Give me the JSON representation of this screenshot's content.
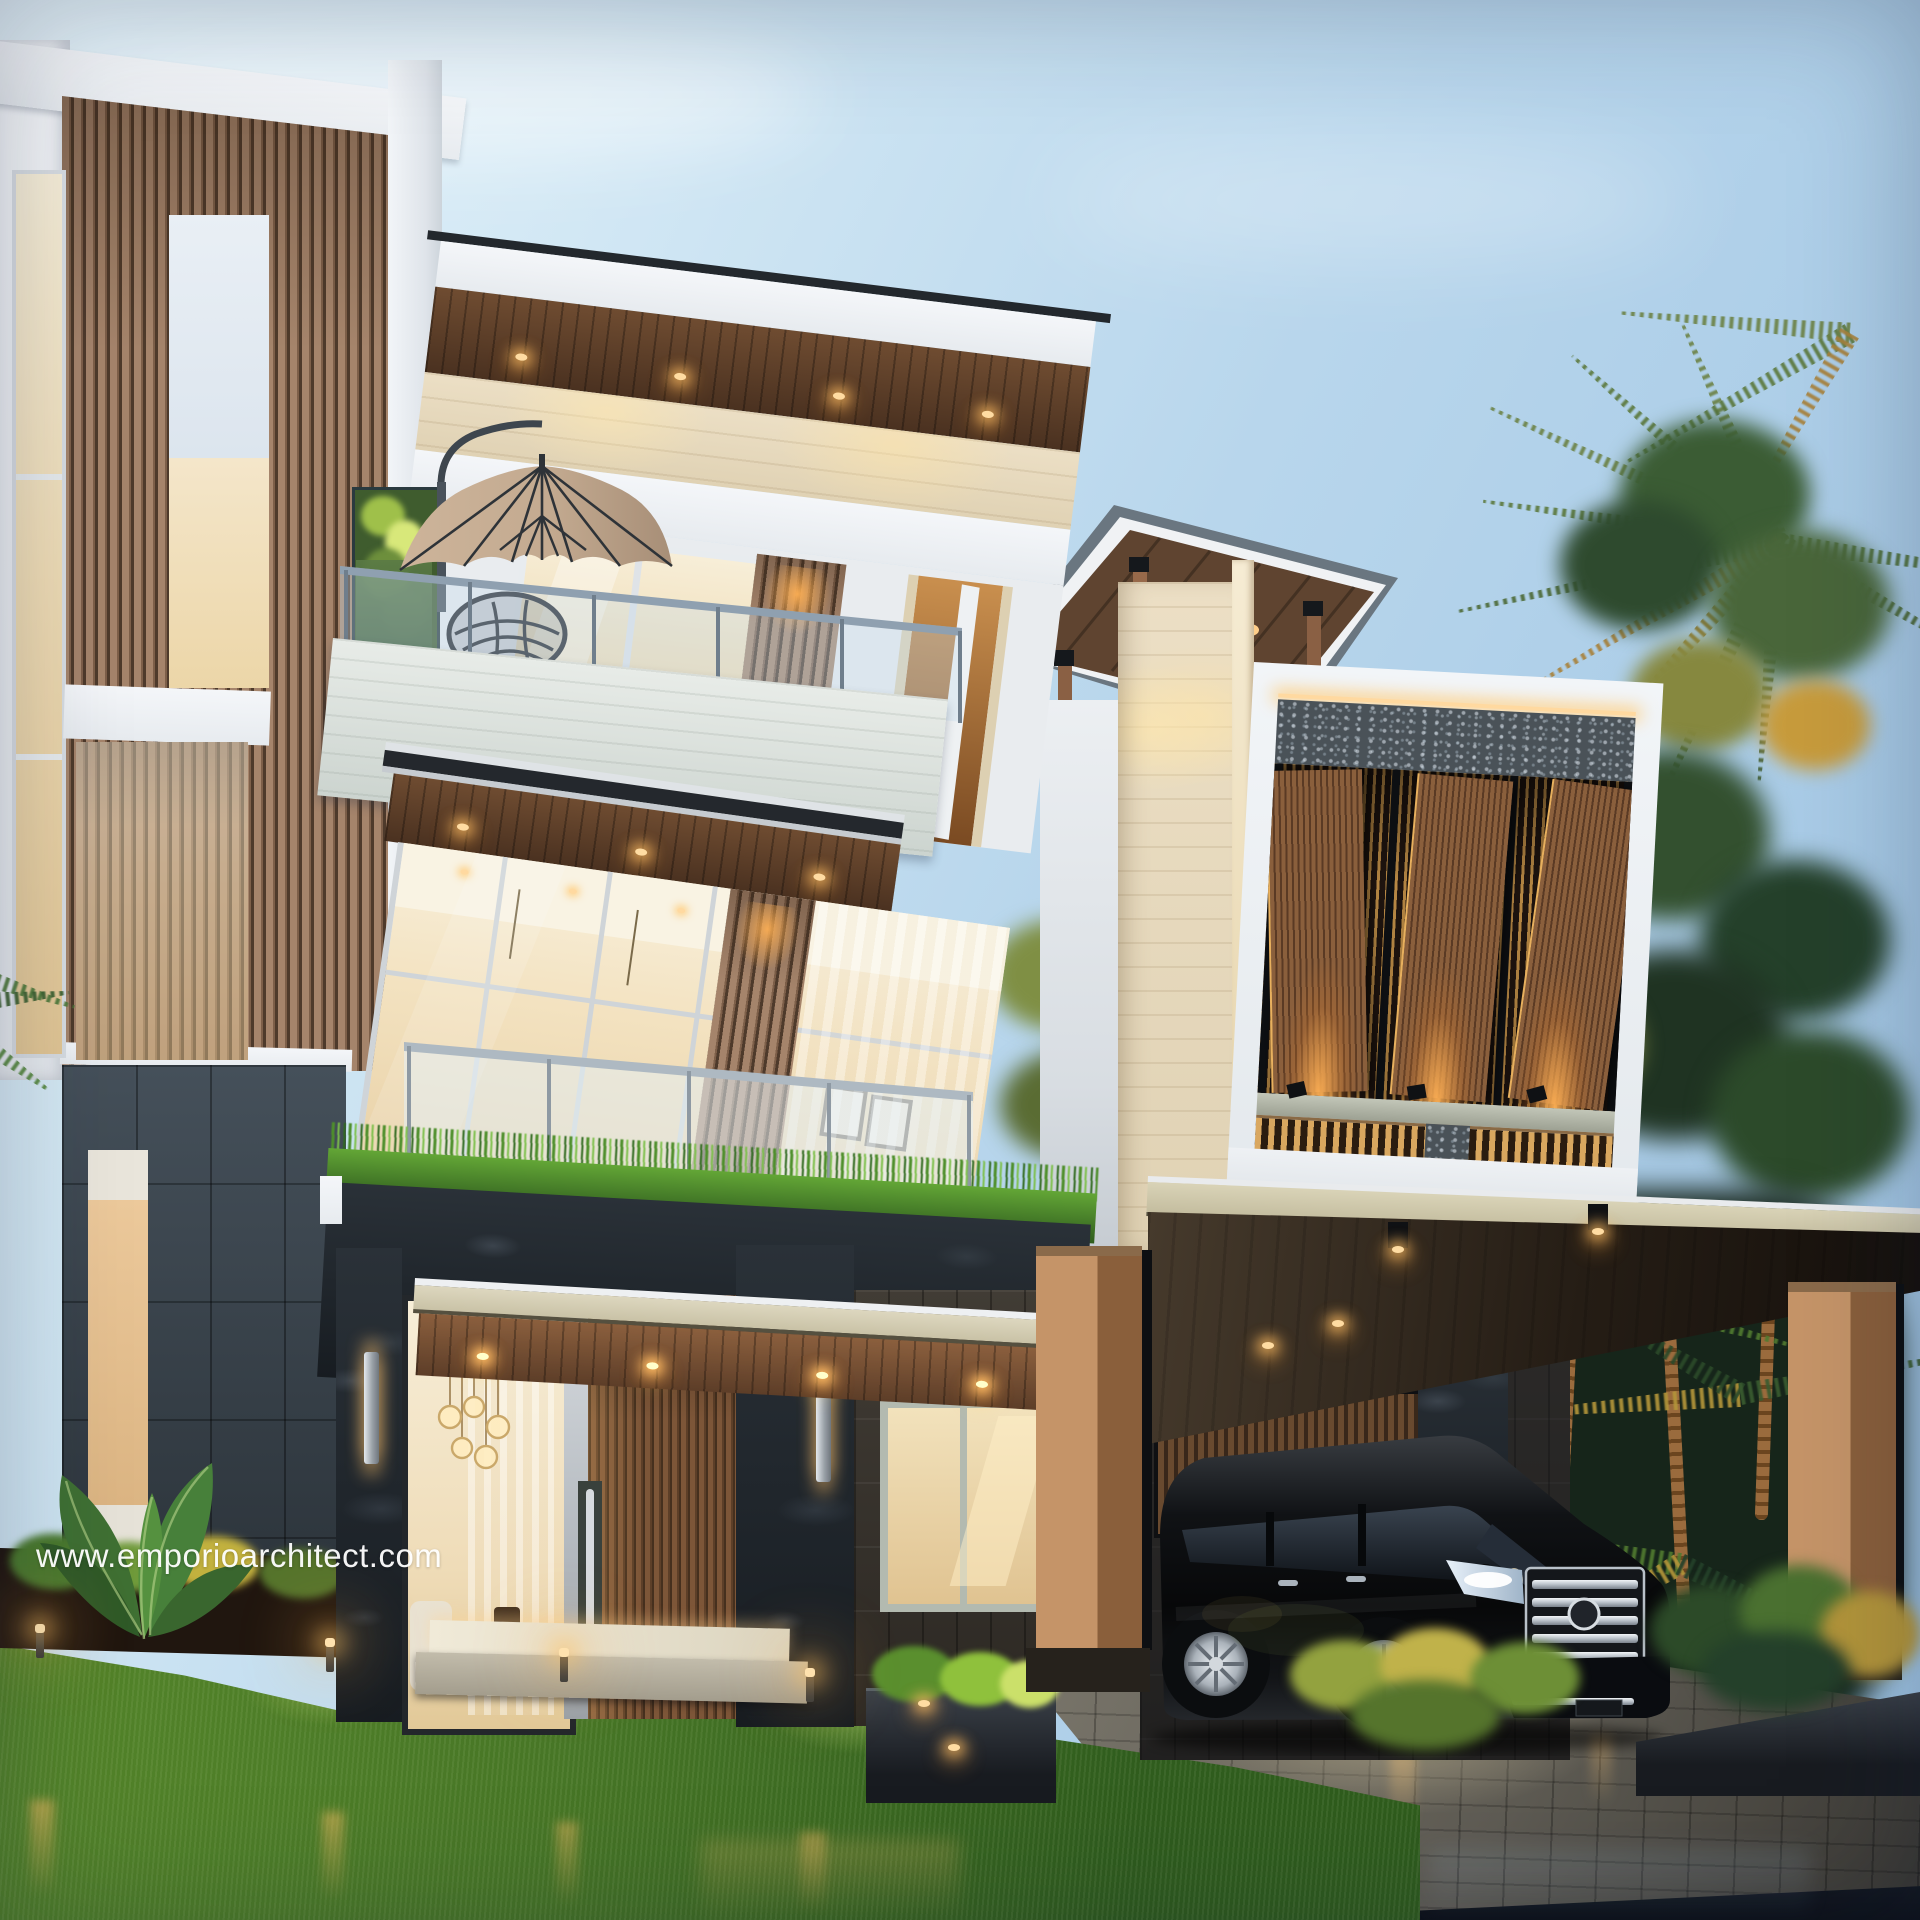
{
  "watermark": {
    "text": "www.emporioarchitect.com",
    "color": "#ffffff"
  },
  "scene": {
    "subject": "modern-tropical-villa-exterior-render-at-dusk",
    "elements": [
      "sky",
      "palm-trees",
      "three-storey-villa",
      "vertical-wood-slat-tower",
      "rooftop-pavilion",
      "wood-louvre-windows",
      "glass-balcony",
      "patio-umbrella",
      "wire-chair",
      "vertical-garden",
      "entrance-porch",
      "pendant-lamp",
      "carport",
      "black-mpv-van",
      "front-lawn",
      "garden-lights",
      "wet-road"
    ]
  },
  "palette": {
    "sky_top": "#dff0f9",
    "sky_bottom": "#9cc2e2",
    "white_fascia": "#f2f5f8",
    "travertine": "#e9dfc8",
    "cool_stone": "#dde2dd",
    "wood_slat": "#9c7b61",
    "wood_soffit": "#5e3f2a",
    "louvre_wood": "#8a5f3c",
    "dark_tile": "#39424a",
    "rough_stone": "#20262b",
    "granite_speckle": "#4a5258",
    "interior_glow": "#f3e3c2",
    "warm_light": "#ffd79a",
    "accent_tan": "#e7c9a0",
    "column_tan": "#b2835a",
    "grass": "#477626",
    "foliage": "#33502f",
    "foliage_gold": "#c79b3c",
    "road": "#12161f",
    "paver": "#6e6b62",
    "van_black": "#0b0d10",
    "chrome": "#d9dee3",
    "umbrella": "#c3aa90"
  }
}
